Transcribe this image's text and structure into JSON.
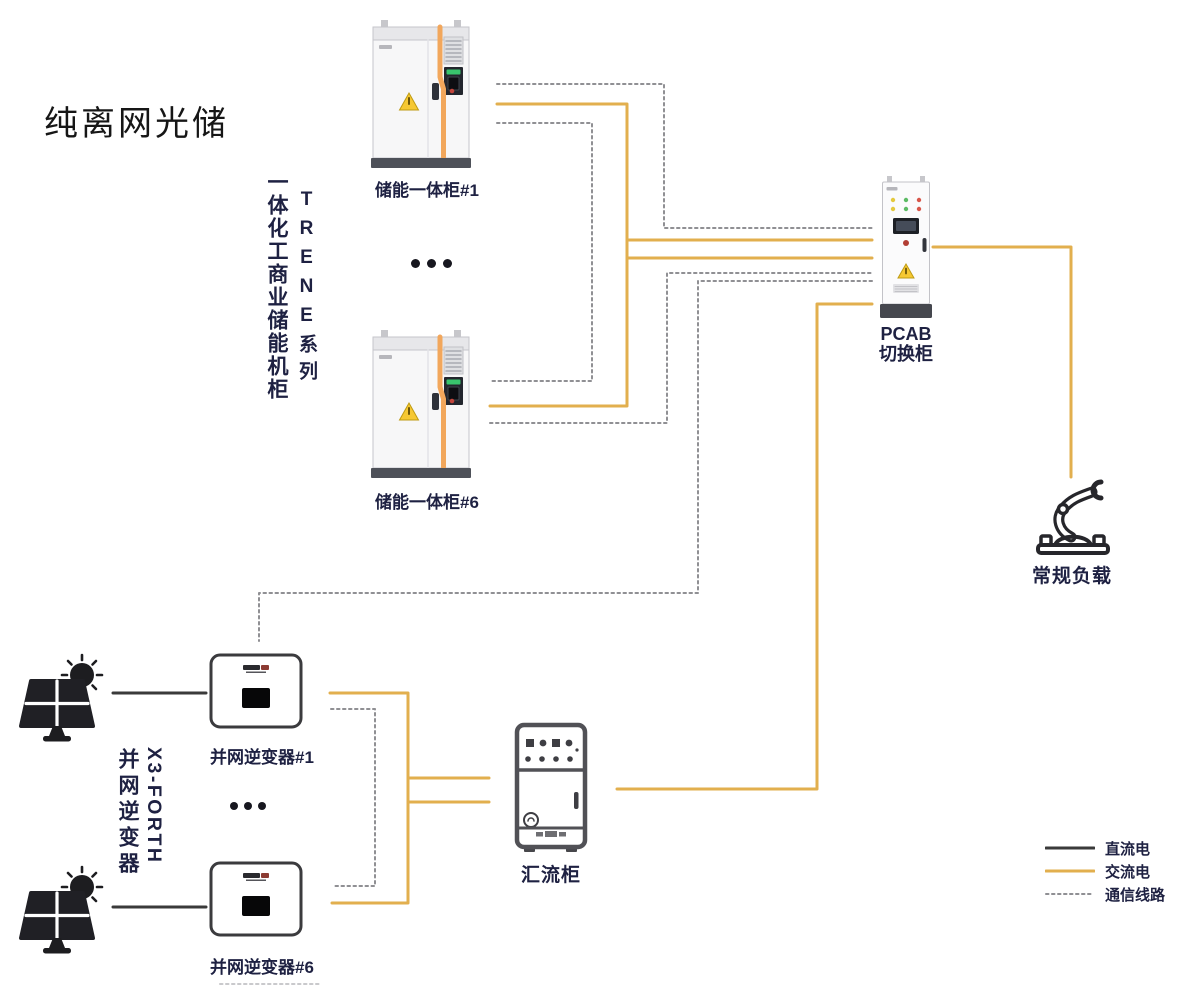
{
  "title": "纯离网光储",
  "colors": {
    "ac": "#E2AF4E",
    "dc": "#3A3A3A",
    "comm": "#8F8F93",
    "label": "#1E2142",
    "stripe": "#F2A75C"
  },
  "storage": {
    "group_label_cn": "一体化工商业储能机柜",
    "group_label_series": "TRENE系列",
    "cabinet1_label": "储能一体柜#1",
    "cabinet6_label": "储能一体柜#6"
  },
  "pcab": {
    "name": "PCAB",
    "label": "切换柜"
  },
  "load": {
    "label": "常规负载"
  },
  "pv": {
    "group_label_model": "X3-FORTH",
    "group_label_cn": "并网逆变器",
    "inverter1_label": "并网逆变器#1",
    "inverter6_label": "并网逆变器#6"
  },
  "combiner": {
    "label": "汇流柜"
  },
  "legend": {
    "dc_label": "直流电",
    "ac_label": "交流电",
    "comm_label": "通信线路"
  }
}
